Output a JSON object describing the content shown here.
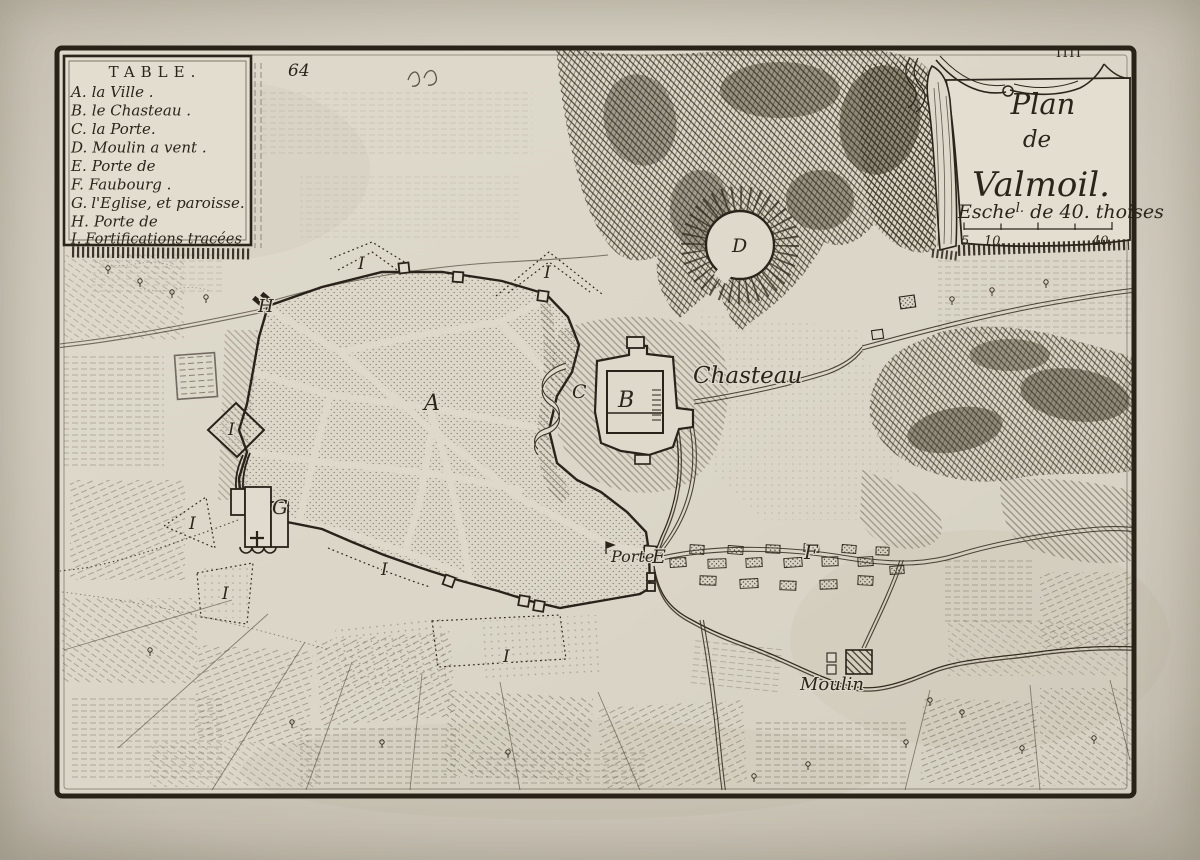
{
  "artwork": {
    "plate_number": "64",
    "folio_number": "IIII"
  },
  "legend": {
    "title": "TABLE.",
    "items": [
      {
        "key": "A.",
        "label": "la Ville ."
      },
      {
        "key": "B.",
        "label": "le Chasteau ."
      },
      {
        "key": "C.",
        "label": "la Porte."
      },
      {
        "key": "D.",
        "label": "Moulin a vent ."
      },
      {
        "key": "E.",
        "label": "Porte de"
      },
      {
        "key": "F.",
        "label": "Faubourg ."
      },
      {
        "key": "G.",
        "label": "l'Eglise, et paroisse."
      },
      {
        "key": "H.",
        "label": "Porte de"
      },
      {
        "key": "I.",
        "label": "Fortifications tracées"
      }
    ]
  },
  "cartouche": {
    "title_line1": "Plan",
    "title_line2": "de",
    "title_line3": "Valmoil.",
    "scale_prefix": "Esche",
    "scale_sup": "l.",
    "scale_rest": " de 40. thoises",
    "scale_tick_labels": [
      "5.",
      "10.",
      "40."
    ]
  },
  "map_labels": {
    "chasteau": "Chasteau",
    "porte": "Porte",
    "moulin": "Moulin",
    "letter_a": "A",
    "letter_b": "B",
    "letter_c": "C",
    "letter_d": "D",
    "letter_e": "E",
    "letter_f": "F",
    "letter_g": "G",
    "letter_h": "H",
    "letter_i": "I"
  },
  "colors": {
    "paper": "#dcd7c9",
    "paper_margin": "#cfc9bc",
    "ink": "#2b241a",
    "ink_light": "#5a5344"
  }
}
